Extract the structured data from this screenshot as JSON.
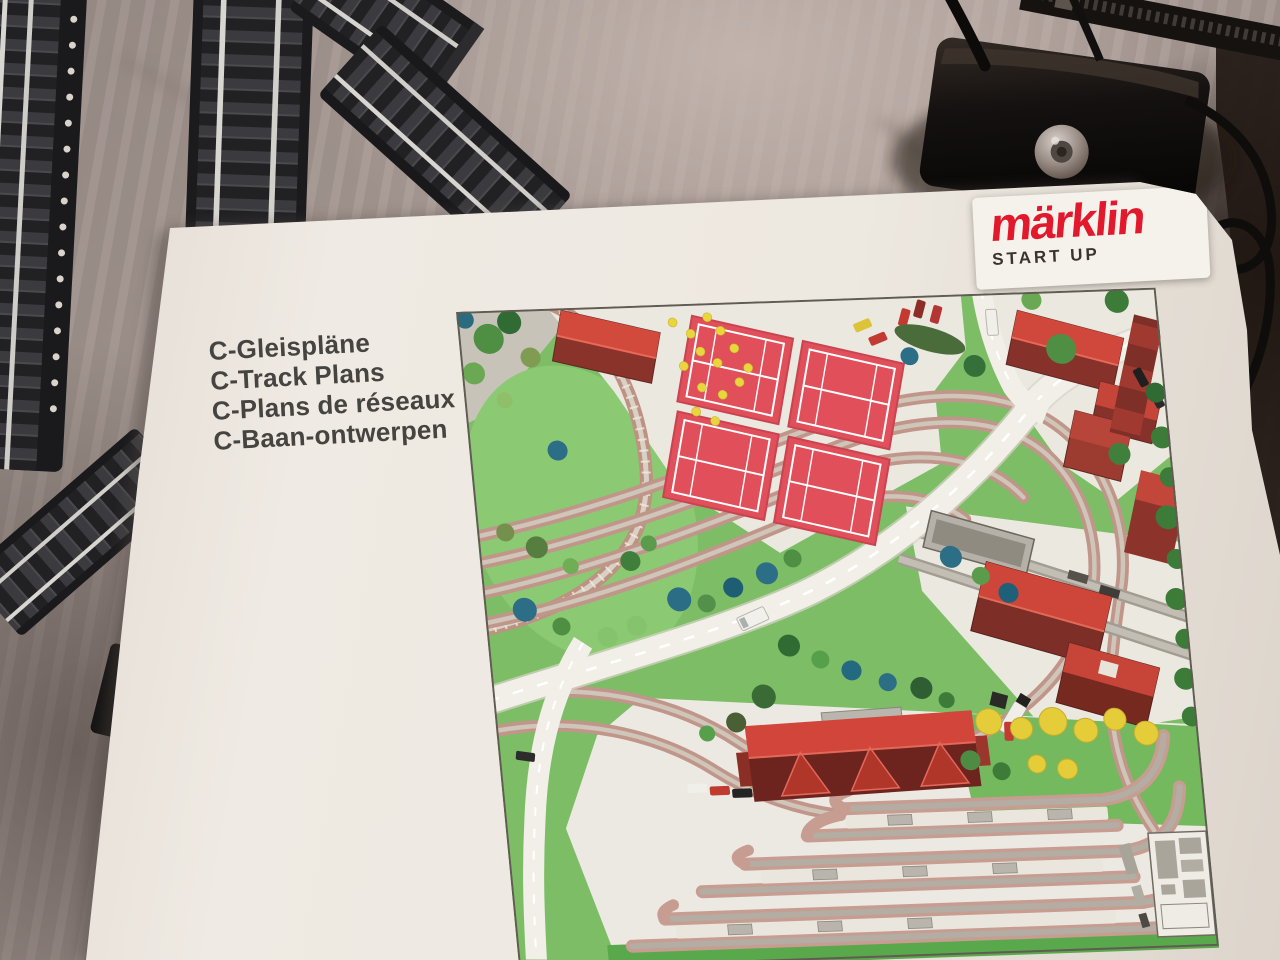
{
  "photo": {
    "description": "Maerklin Start Up booklet with C-track plan lying on bed sheet next to C-track pieces and a power controller",
    "fabric_color": "#a2958f",
    "objects": [
      "c-track-pieces",
      "power-controller",
      "track-plans-booklet"
    ]
  },
  "booklet": {
    "title_lines": [
      "C-Gleispläne",
      "C-Track Plans",
      "C-Plans de réseaux",
      "C-Baan-ontwerpen"
    ],
    "brand": {
      "logo_text": "märklin",
      "subtitle": "START UP",
      "logo_color": "#e2182c",
      "paper_color": "#ece7e0"
    }
  },
  "map": {
    "theme_colors": {
      "grass": "#7cbd66",
      "plaza": "#ebe8e0",
      "ballast": "#c0968a",
      "tennis_court_red": "#e04f5a",
      "roof_red": "#d0483c",
      "roof_shadow": "#7c2e27",
      "yellow_tree": "#e5cd3a",
      "conifer_teal": "#2b6e85"
    },
    "features": [
      "park with loop track",
      "four tennis courts",
      "clubhouse with terrace seating",
      "town houses",
      "industrial sidings with warehouses",
      "main double-track curve",
      "station building",
      "six-track station yard with platforms",
      "roads with vehicles",
      "trees and hedges",
      "corner inset diagram"
    ]
  }
}
